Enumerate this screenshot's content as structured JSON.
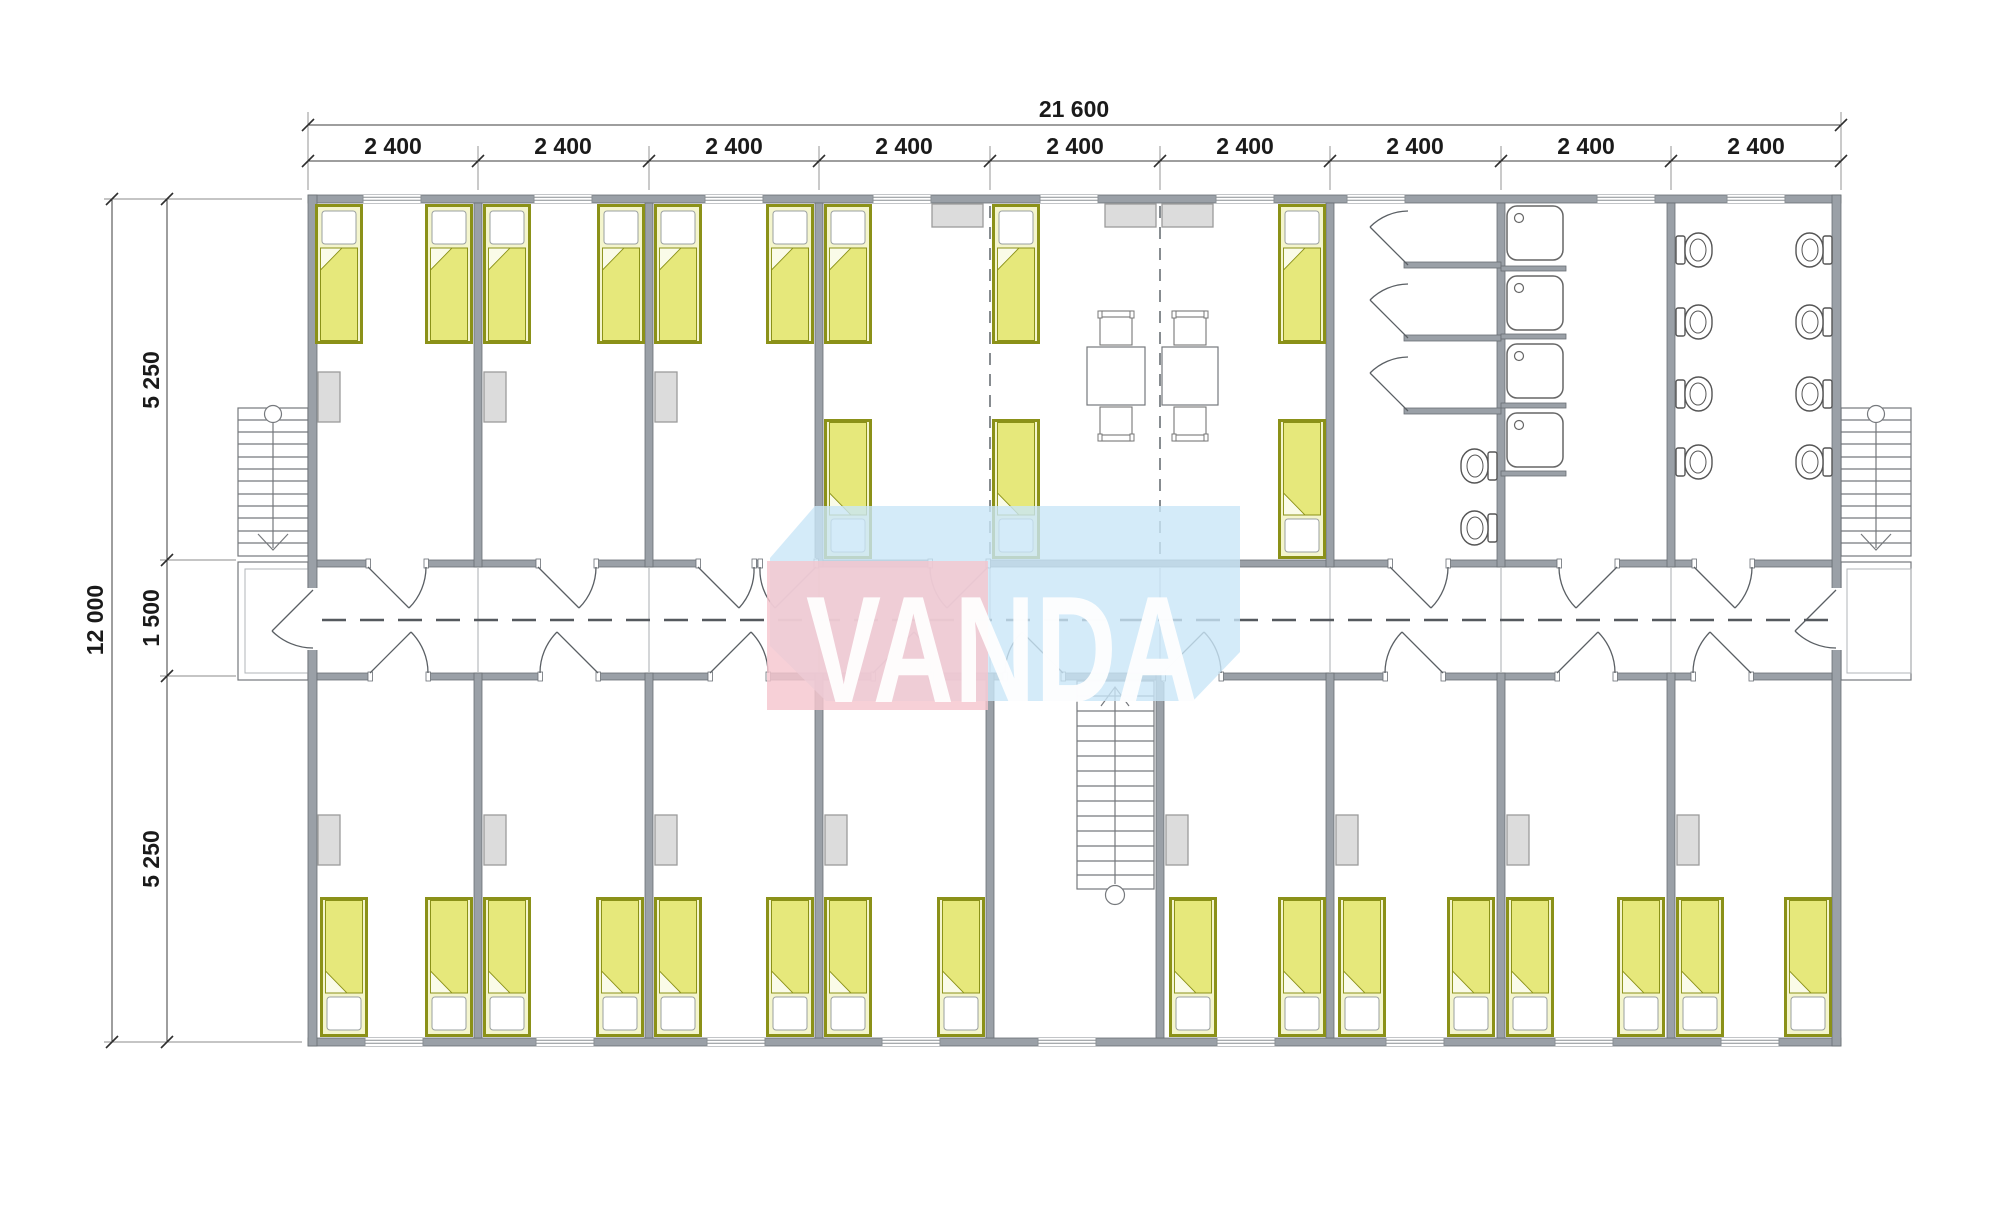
{
  "watermark": {
    "text": "VANDA"
  },
  "dimensions": {
    "top_total": "21 600",
    "top_segments": [
      "2 400",
      "2 400",
      "2 400",
      "2 400",
      "2 400",
      "2 400",
      "2 400",
      "2 400",
      "2 400"
    ],
    "left_total": "12 000",
    "left_top": "5 250",
    "left_middle": "1 500",
    "left_bottom": "5 250"
  },
  "colors": {
    "wall": "#9aa0a7",
    "wall_edge": "#6a6f75",
    "line": "#76797d",
    "dim_text": "#1a1a1a",
    "bed_frame": "#8b9118",
    "bed_fill": "#f4f5cd",
    "bed_blanket": "#e6e87b",
    "furniture_gray": "#dcdcdc",
    "watermark_pink": "#f5c6ce",
    "watermark_blue": "#c9e6f7",
    "watermark_text": "#ffffff"
  }
}
